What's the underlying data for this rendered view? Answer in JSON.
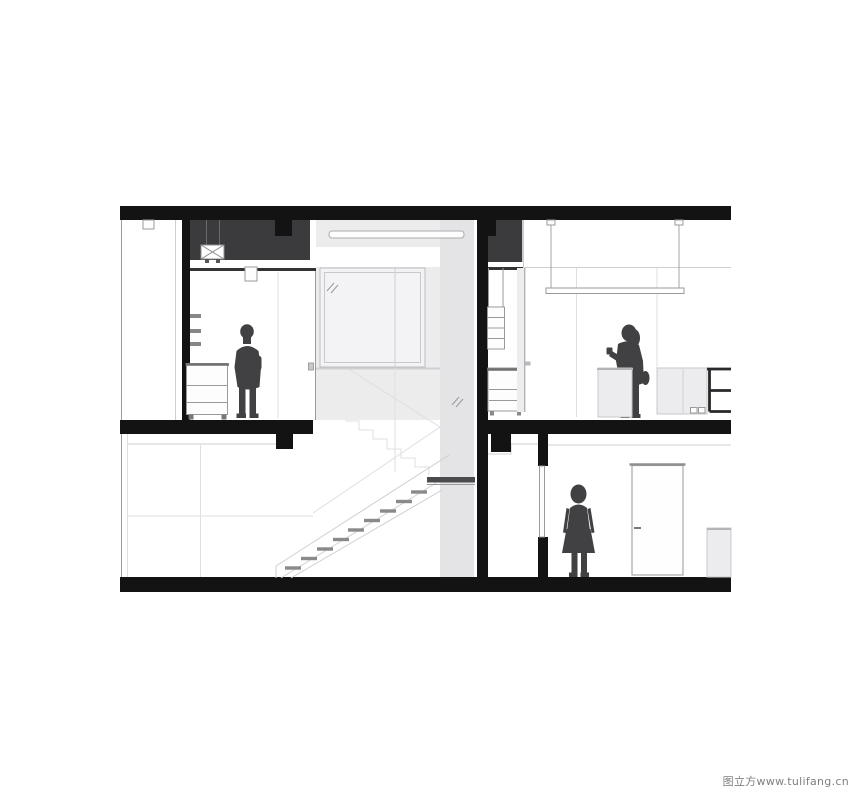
{
  "watermark": {
    "text": "图立方www.tulifang.cn"
  },
  "colors": {
    "structure_black": "#131314",
    "loft_charcoal": "#3b3b3d",
    "figure_gray": "#414143",
    "panel_gray": "#ececed",
    "shaft_gray": "#e4e4e6",
    "furniture_fill": "#fdfdfd",
    "furniture_gray": "#ececee",
    "line_dark": "#6f6f72",
    "line_medium": "#9a9a9d",
    "line_light": "#cfcfd2",
    "line_faint": "#dfdfe2",
    "tread_gray": "#8a8a8d",
    "watermark_gray": "#7f7f7f"
  },
  "drawing": {
    "type": "architectural-section-two-storey",
    "figures": [
      "standing-man-upper-left-bedroom",
      "standing-woman-upper-right-kitchen",
      "standing-woman-lower-right-room"
    ]
  }
}
